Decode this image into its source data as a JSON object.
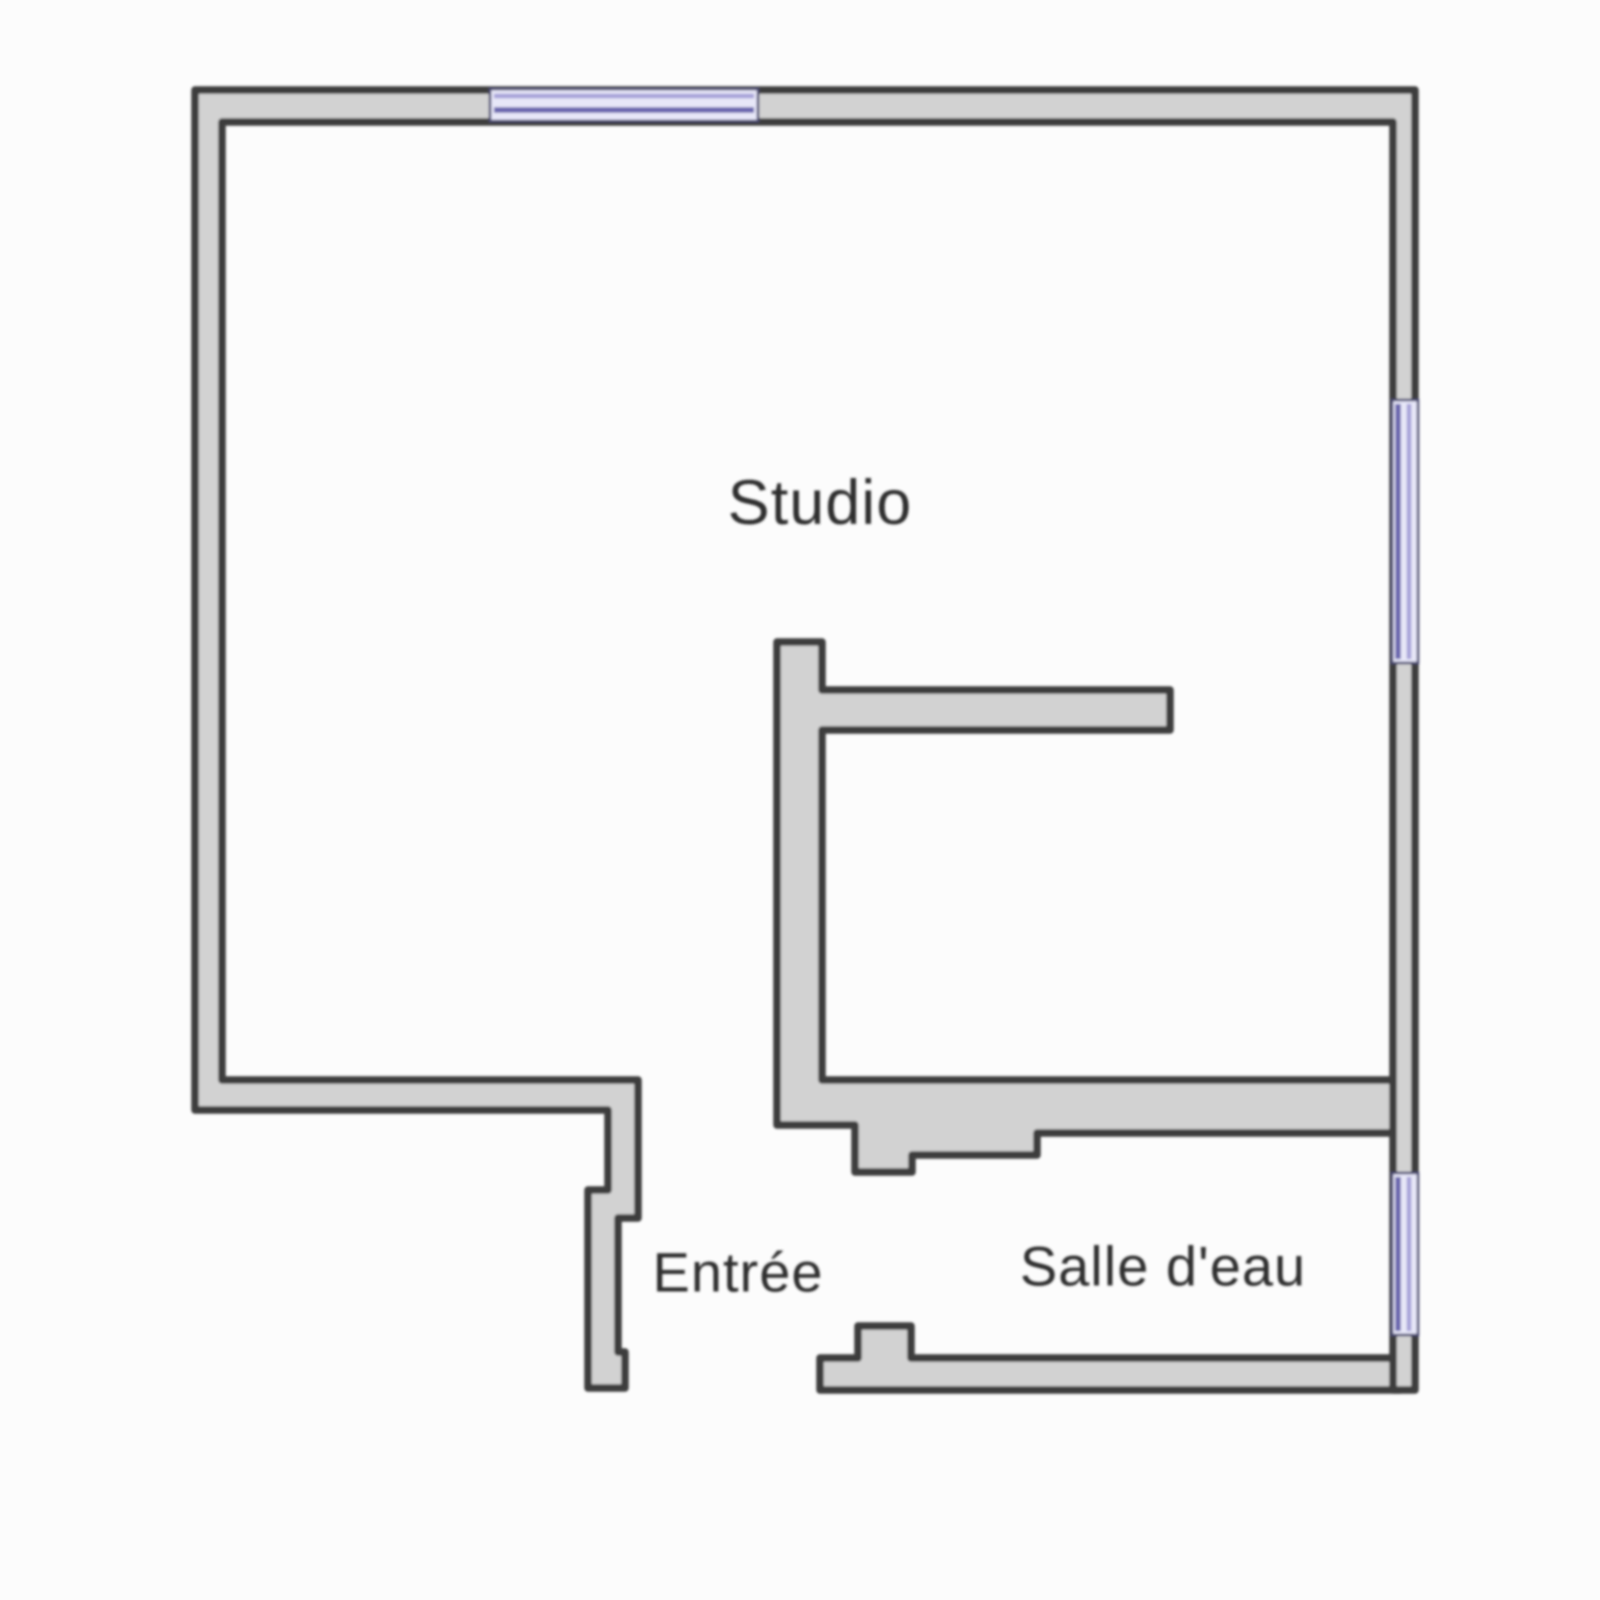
{
  "page": {
    "background": "#fcfcfc"
  },
  "plan": {
    "rooms": [
      {
        "id": "studio",
        "label": "Studio"
      },
      {
        "id": "entree",
        "label": "Entrée"
      },
      {
        "id": "salle-deau",
        "label": "Salle d'eau"
      }
    ],
    "windows": [
      {
        "name": "north-window"
      },
      {
        "name": "east-window-studio"
      },
      {
        "name": "east-window-bathroom"
      }
    ],
    "colors": {
      "background": "#fcfcfc",
      "wall_fill": "#d2d2d2",
      "wall_stroke": "#3d3d3d",
      "window_fill": "#e7e7f8",
      "window_line_dark": "#6b66ae",
      "window_line_light": "#a7a3d8",
      "window_edge": "#4a4a72",
      "label_color": "#2d2d2d"
    }
  }
}
